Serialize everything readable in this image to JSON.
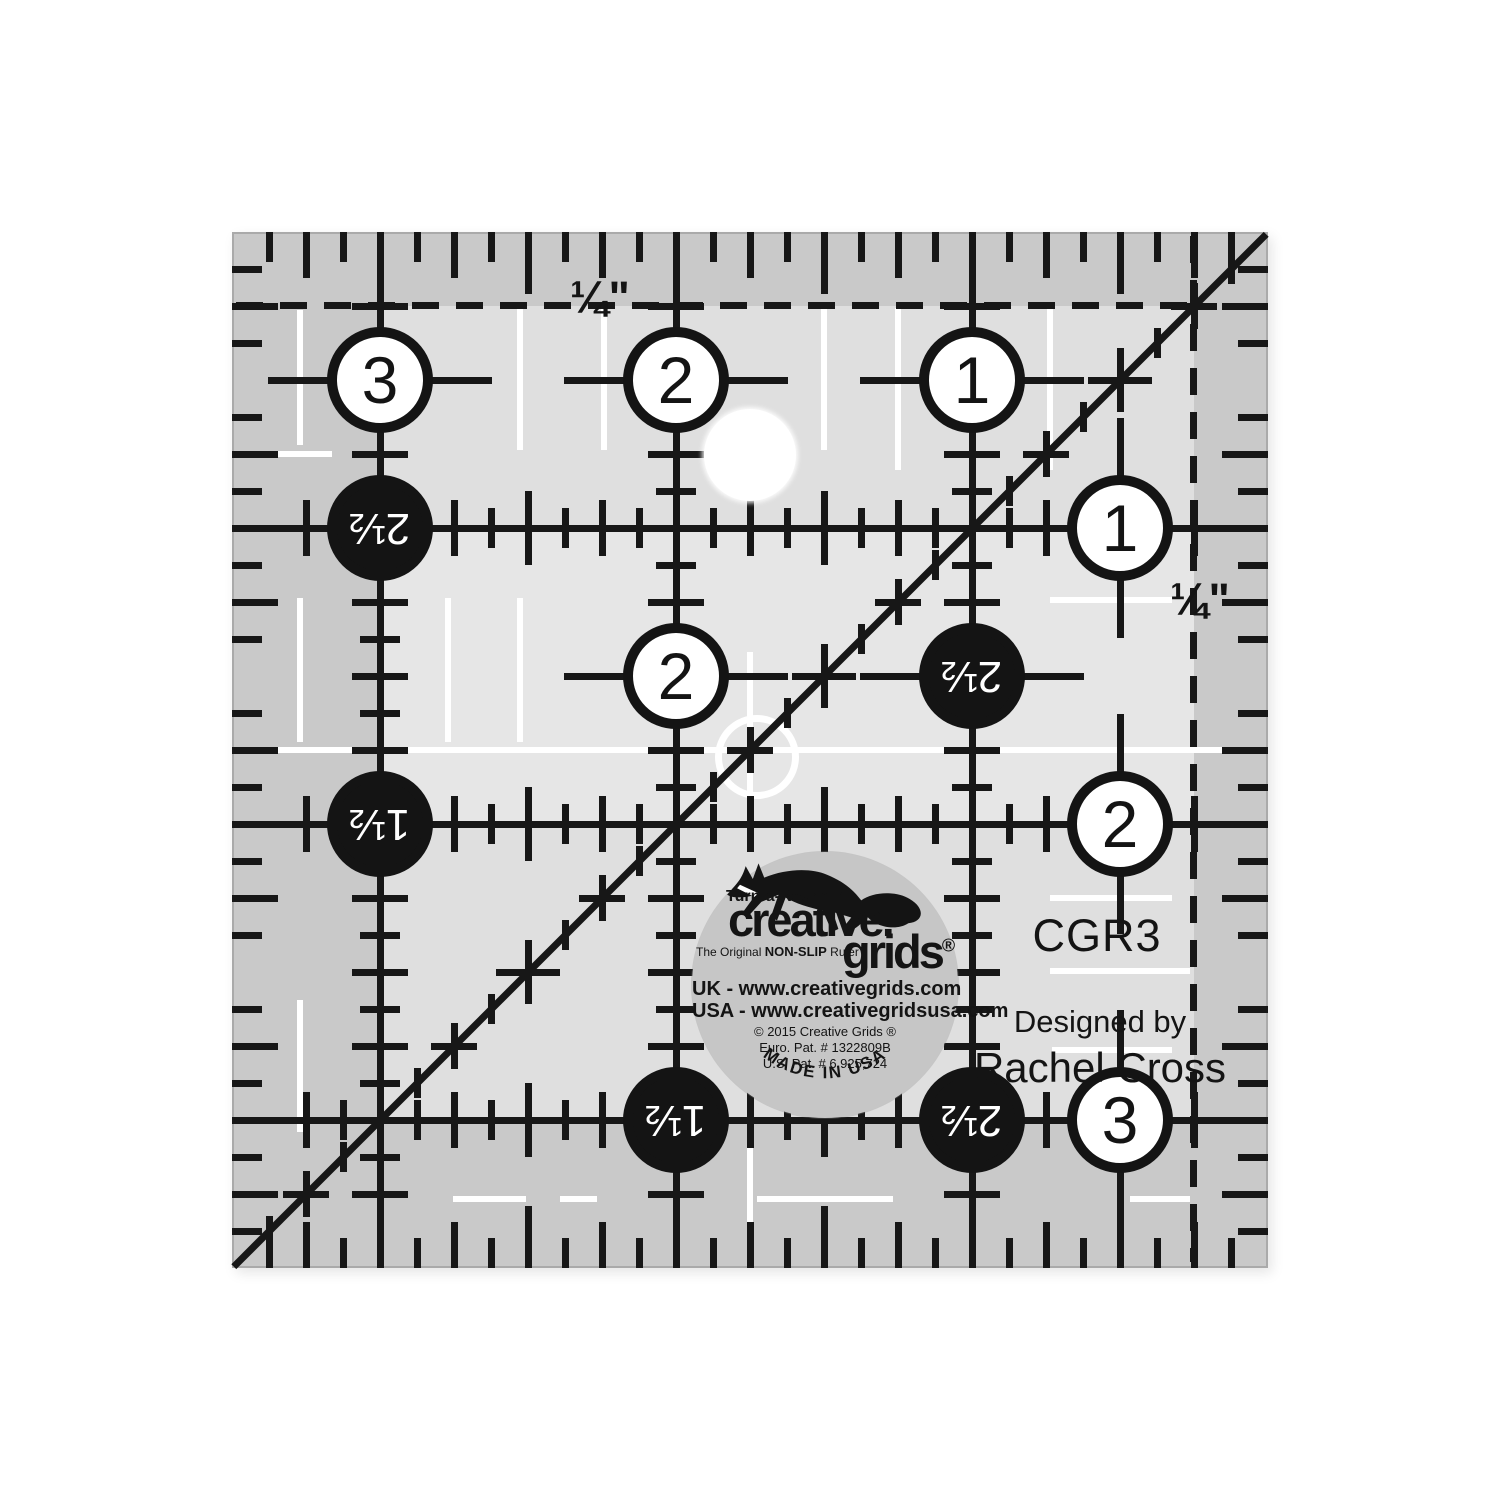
{
  "product": {
    "model": "CGR3",
    "designed_by": "Designed by",
    "designer": "Rachel Cross"
  },
  "ruler": {
    "quarter_label_top": "¼\"",
    "quarter_label_right": "¼\"",
    "white_circles": [
      {
        "label": "3",
        "x": 148,
        "y": 148
      },
      {
        "label": "2",
        "x": 444,
        "y": 148
      },
      {
        "label": "1",
        "x": 740,
        "y": 148
      },
      {
        "label": "1",
        "x": 888,
        "y": 296
      },
      {
        "label": "2",
        "x": 888,
        "y": 592
      },
      {
        "label": "3",
        "x": 888,
        "y": 888
      },
      {
        "label": "2",
        "x": 444,
        "y": 444
      }
    ],
    "black_circles": [
      {
        "label": "2½",
        "x": 148,
        "y": 296
      },
      {
        "label": "2½",
        "x": 740,
        "y": 444
      },
      {
        "label": "1½",
        "x": 148,
        "y": 592
      },
      {
        "label": "1½",
        "x": 444,
        "y": 888
      },
      {
        "label": "2½",
        "x": 740,
        "y": 888
      }
    ]
  },
  "logo": {
    "turnaround": "Turn-a-Round™",
    "brand_line1": "creative.",
    "brand_line2": "grids",
    "registered": "®",
    "tagline_1": "The Original ",
    "tagline_2": "NON-SLIP",
    "tagline_3": " Ruler",
    "uk_line": "UK - www.creativegrids.com",
    "usa_line": "USA - www.creativegridsusa.com",
    "copyright_line": "© 2015  Creative Grids ®",
    "euro_pat": "Euro. Pat. # 1322809B",
    "us_pat": "U.S. Pat. # 6,925,724",
    "made_in": "MADE IN USA"
  },
  "colors": {
    "mark_black": "#171717",
    "ruler_base": "#c9c9c9",
    "ruler_inner": "#dfdfdf",
    "ruler_band": "#e6e6e6",
    "seal_gray": "#c6c6c6"
  }
}
